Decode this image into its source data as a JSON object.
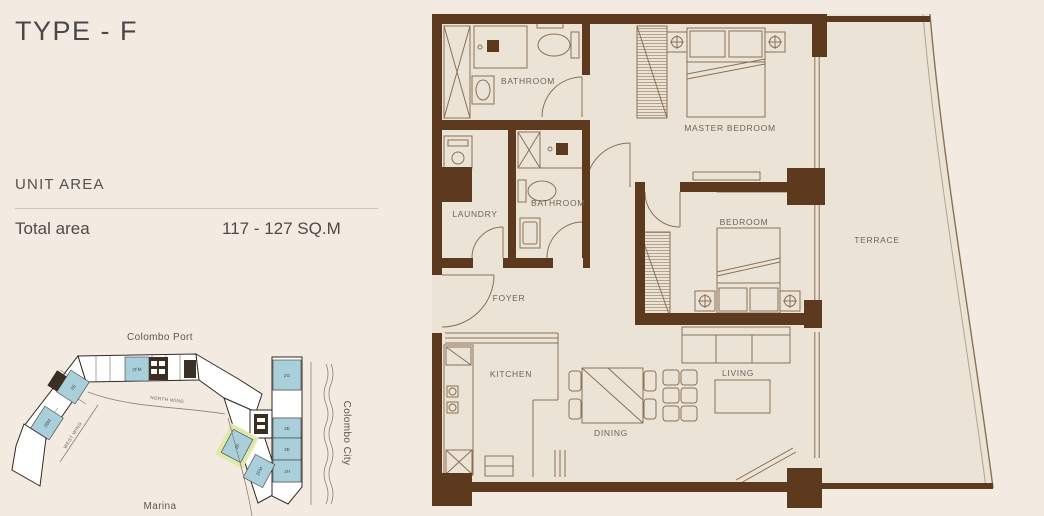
{
  "panel": {
    "title": "TYPE - F",
    "unit_area_heading": "UNIT AREA",
    "total_area_label": "Total area",
    "total_area_value": "117 - 127 SQ.M"
  },
  "floor_plan": {
    "rooms": {
      "bathroom_top": "BATHROOM",
      "master_bedroom": "MASTER BEDROOM",
      "laundry": "LAUNDRY",
      "bathroom_mid": "BATHROOM",
      "bedroom": "BEDROOM",
      "foyer": "FOYER",
      "kitchen": "KITCHEN",
      "dining": "DINING",
      "living": "LIVING",
      "terrace": "TERRACE"
    },
    "colors": {
      "wall": "#5d3a1e",
      "floor": "#ece3d7",
      "furniture_line": "#8a7154",
      "label_text": "#6e635a"
    }
  },
  "site_plan": {
    "map_labels": {
      "top": "Colombo Port",
      "right": "Colombo City",
      "bottom": "Marina"
    },
    "wing_labels": {
      "north": "NORTH WING",
      "west": "WEST WING"
    },
    "unit_labels": {
      "north_wing": "2FM",
      "west_upper": "2E",
      "west_lower": "2BM",
      "east_1": "2G",
      "east_2": "2E",
      "east_3": "2E",
      "east_4": "2H",
      "highlight": "2F",
      "below_highlight": "2FM"
    },
    "colors": {
      "unit_fill": "#a9cfdb",
      "highlight_glow": "#dfe9ac",
      "outline": "#2f2a24"
    }
  }
}
